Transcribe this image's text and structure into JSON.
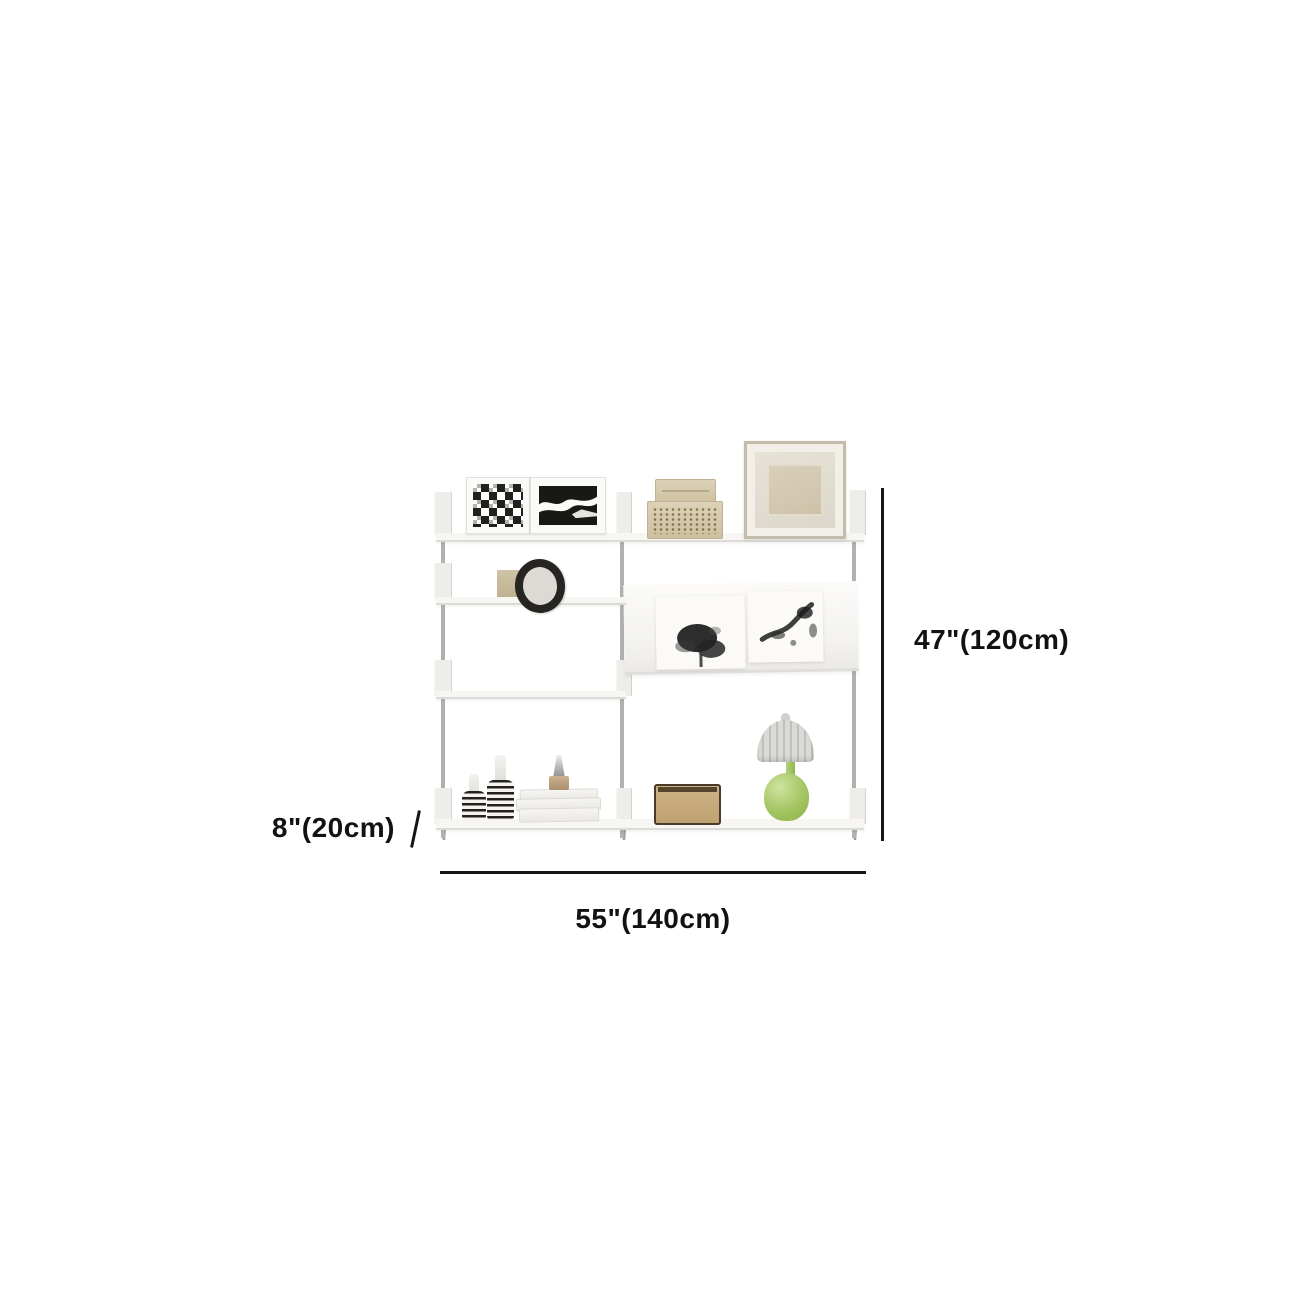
{
  "diagram": {
    "type": "product-dimension-diagram",
    "product": "white-modular-wall-mounted-shelving-unit",
    "dimensions": {
      "height_label": "47\"(120cm)",
      "depth_label": "8\"(20cm)",
      "width_label": "55\"(140cm)"
    },
    "colors": {
      "background": "#ffffff",
      "dimension_line": "#161616",
      "shelf_white": "#f7f6f3",
      "post_gray": "#b2b1ae",
      "decor_beige": "#d3c5a6",
      "ink_black": "#1c1c1c",
      "lamp_green": "#a3c562",
      "lamp_shade_gray": "#d2d2ce"
    },
    "decor_items": [
      "geometric-cube-art-frame",
      "abstract-wave-art-frame",
      "woven-storage-box-stack",
      "large-square-photo-frame",
      "small-beige-box",
      "round-black-ring-ornament",
      "pebble-ornament",
      "ink-art-print-left",
      "ink-art-print-right",
      "striped-vase-small",
      "striped-vase-large",
      "white-book-stack",
      "perfume-bottle",
      "rattan-speaker-box",
      "green-mushroom-table-lamp"
    ]
  }
}
